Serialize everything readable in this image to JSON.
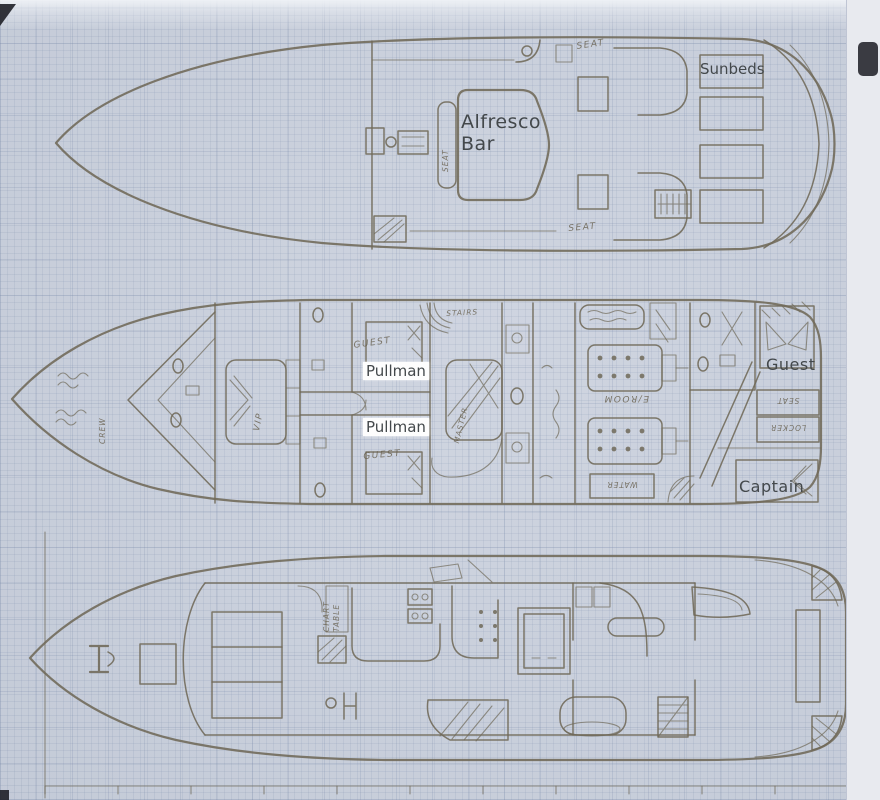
{
  "scan": {
    "paper_color": "#ccd2de",
    "ink_color": "#6f6958",
    "typed_text_color": "#43484b",
    "description": "Scanned hand-drawn yacht deck plans on graph paper, three decks"
  },
  "decks": {
    "sun_deck": {
      "typed": {
        "sunbeds": "Sunbeds",
        "alfresco_bar": "Alfresco Bar"
      },
      "hand": {
        "seat_top": "SEAT",
        "seat_bottom": "SEAT",
        "seat_bench": "SEAT"
      }
    },
    "lower_deck": {
      "typed": {
        "pullman_fwd": "Pullman",
        "pullman_aft": "Pullman",
        "guest_aft": "Guest",
        "captain": "Captain"
      },
      "hand": {
        "crew": "CREW",
        "vip": "VIP",
        "guest_fwd_upper": "GUEST",
        "guest_fwd_lower": "GUEST",
        "stairs": "STAIRS",
        "master": "MASTER",
        "engine_room": "E/ROOM",
        "water": "WATER",
        "seat": "SEAT",
        "locker": "LOCKER"
      }
    },
    "main_deck": {
      "hand": {
        "chart_table": "CHART TABLE"
      }
    }
  }
}
